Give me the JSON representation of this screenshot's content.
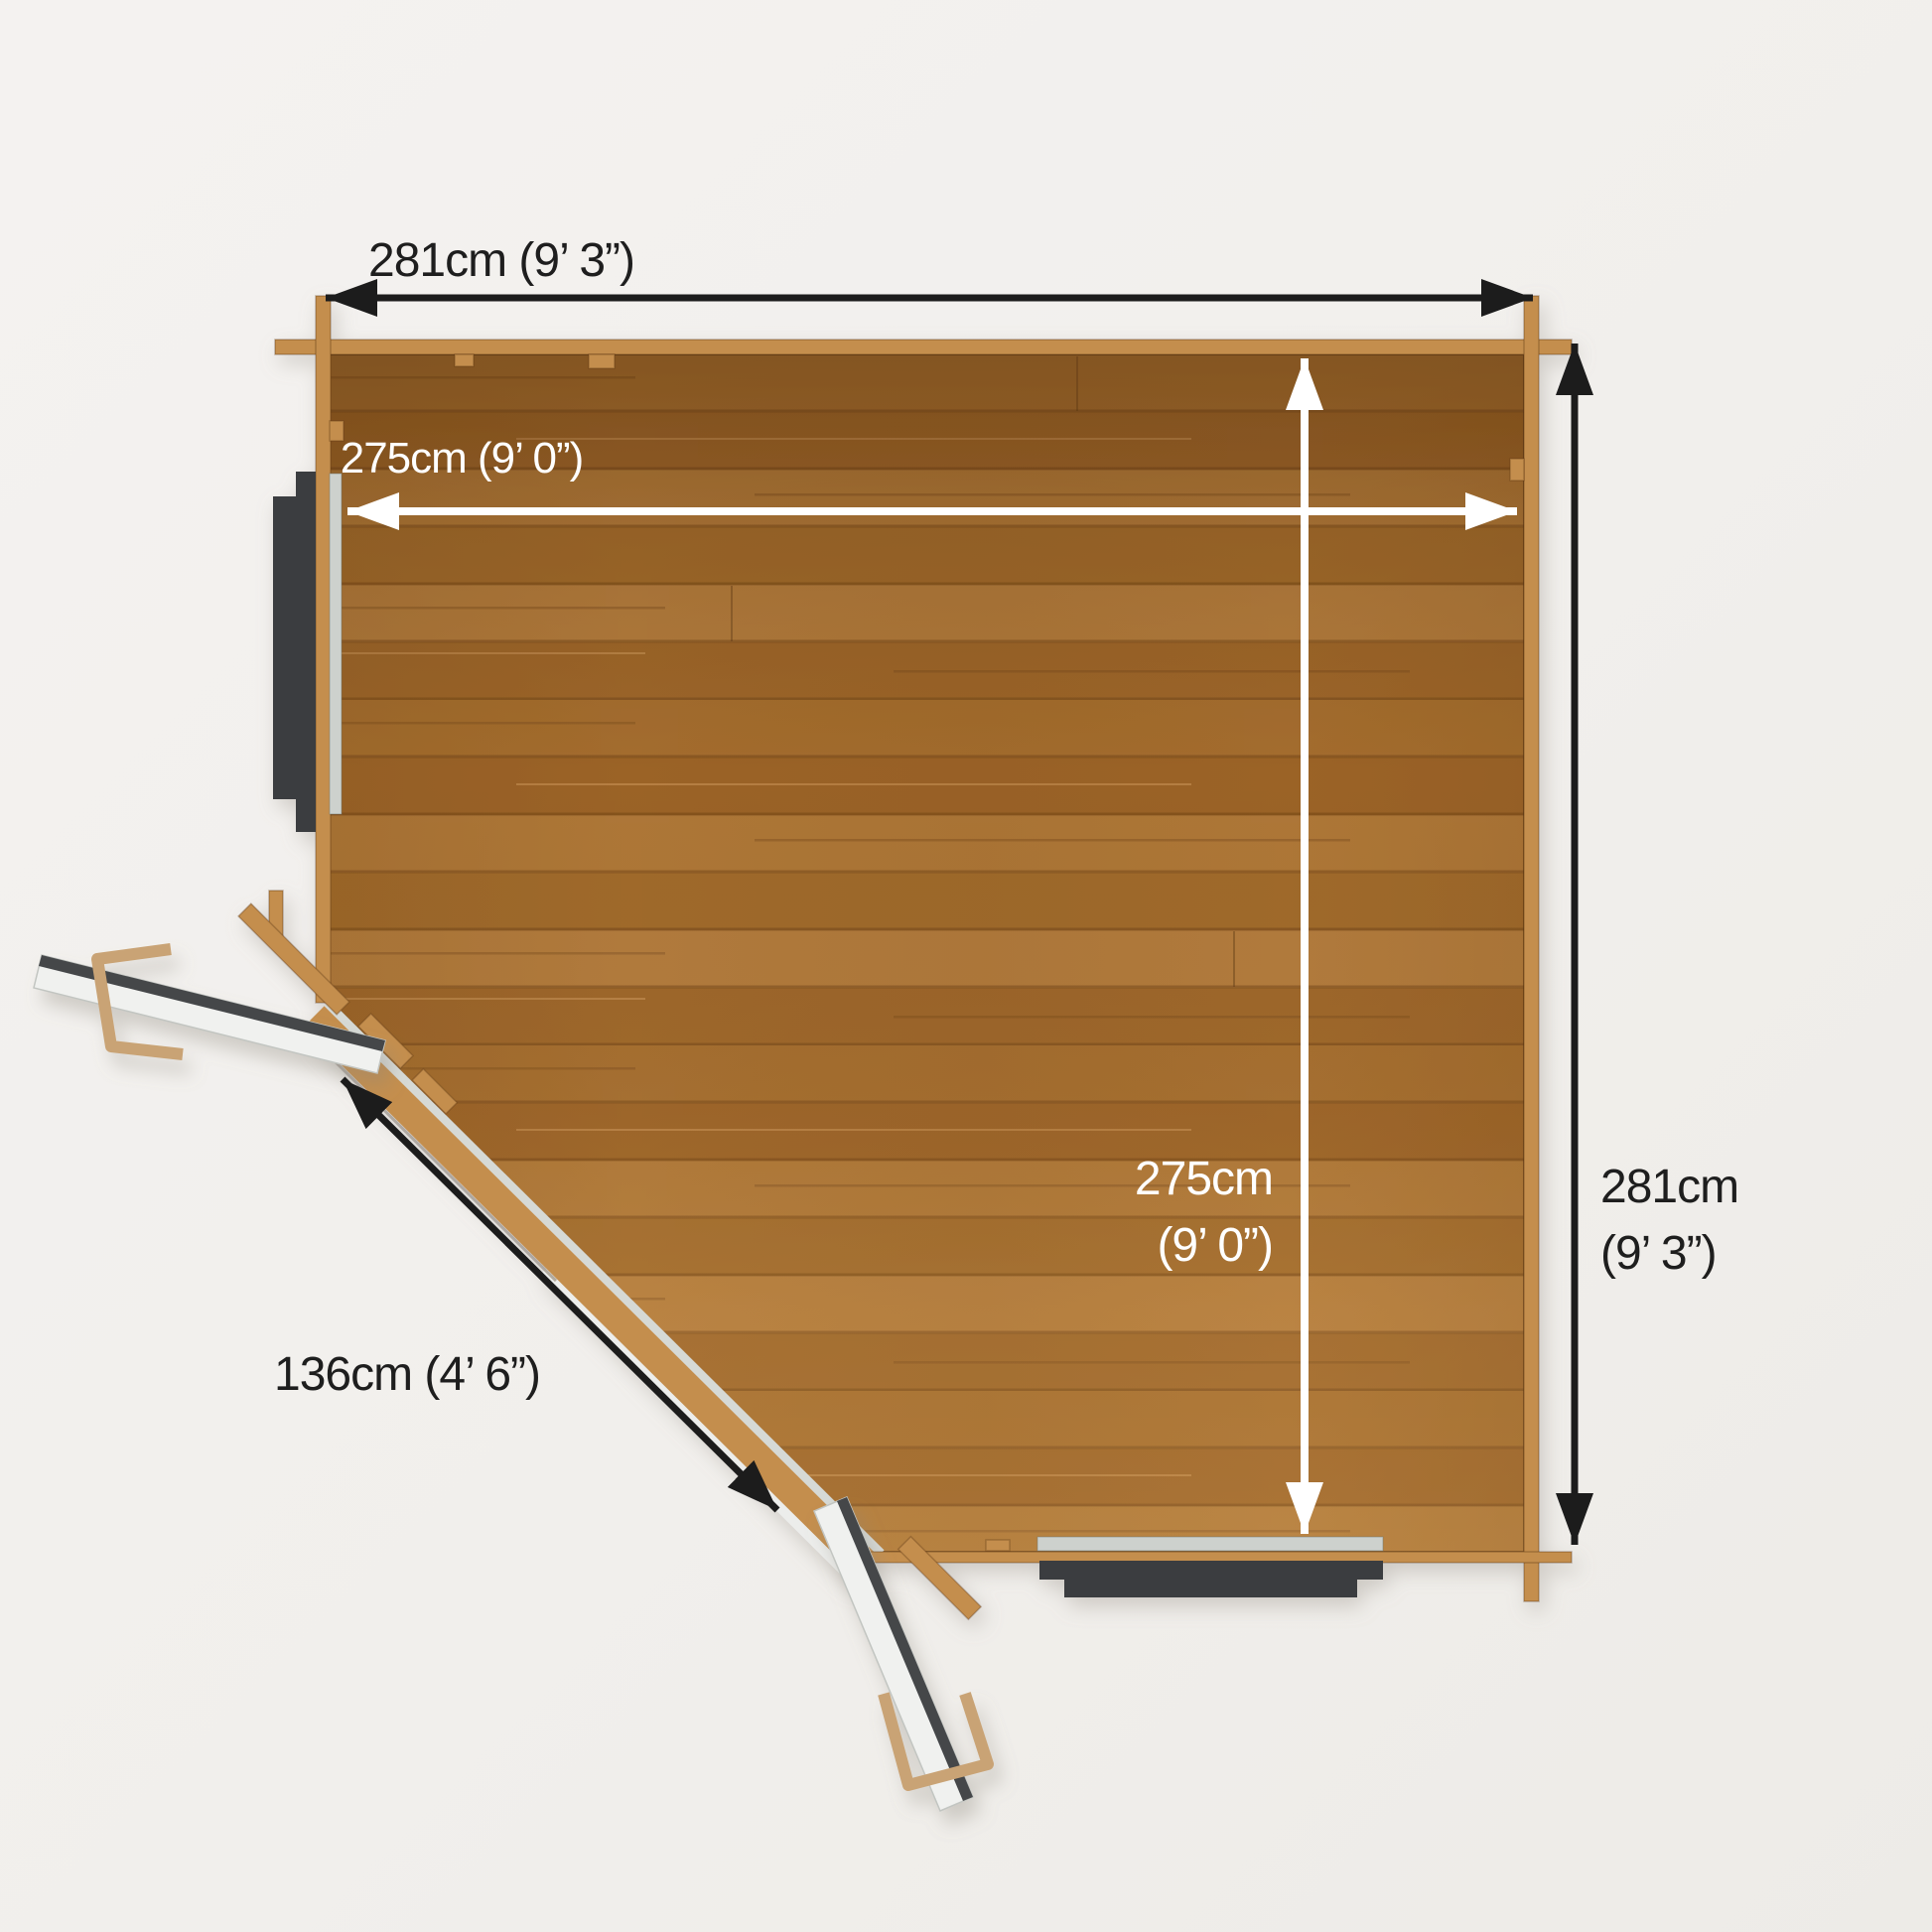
{
  "dimensions": {
    "outer_width": {
      "label": "281cm (9’ 3”)"
    },
    "inner_width": {
      "label": "275cm  (9’ 0”)"
    },
    "inner_depth": {
      "line1": "275cm",
      "line2": "(9’ 0”)"
    },
    "outer_depth": {
      "line1": "281cm",
      "line2": "(9’ 3”)"
    },
    "door_width": {
      "label": "136cm  (4’ 6”)"
    }
  },
  "colors": {
    "bg": "#f1efec",
    "ink": "#1e1e1e",
    "arrow-black": "#1c1c1c",
    "arrow-white": "#ffffff",
    "wall-wood": "#c48e4e",
    "plank-1": "#a46d2e",
    "plank-2": "#9b6327",
    "plank-3": "#ae7737",
    "plank-4": "#a06a2b",
    "plank-5": "#b27b3c",
    "plank-6": "#9d662a",
    "plank-line": "#6f4418",
    "frame-dark": "#3b3e41",
    "sill": "#cdd1cd",
    "threshold": "#d6d9d5",
    "outer-strip": "#ecedeb",
    "door-face": "#f0f1ef",
    "door-edge": "#44474a",
    "handle": "#c9a374"
  },
  "icons": {
    "dimension-arrowhead": "filled-triangle"
  }
}
